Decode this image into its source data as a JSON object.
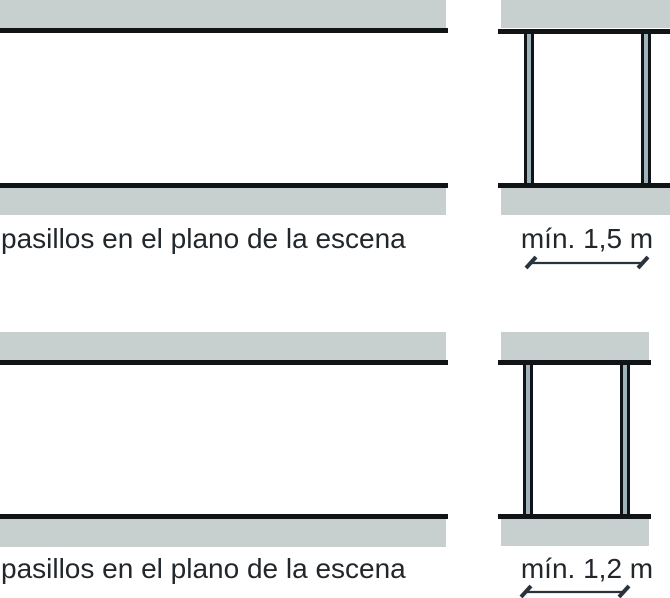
{
  "diagrams": [
    {
      "id": "top",
      "plan_label": "pasillos en el plano de la escena",
      "dimension_label": "mín. 1,5 m"
    },
    {
      "id": "bottom",
      "plan_label": "pasillos en el plano de la escena",
      "dimension_label": "mín. 1,2 m"
    }
  ],
  "colors": {
    "band_gray": "#c8d0cf",
    "outline_black": "#111417",
    "post_fill": "#9fb3ba",
    "text": "#22272b",
    "dimension_line": "#2a333b"
  }
}
